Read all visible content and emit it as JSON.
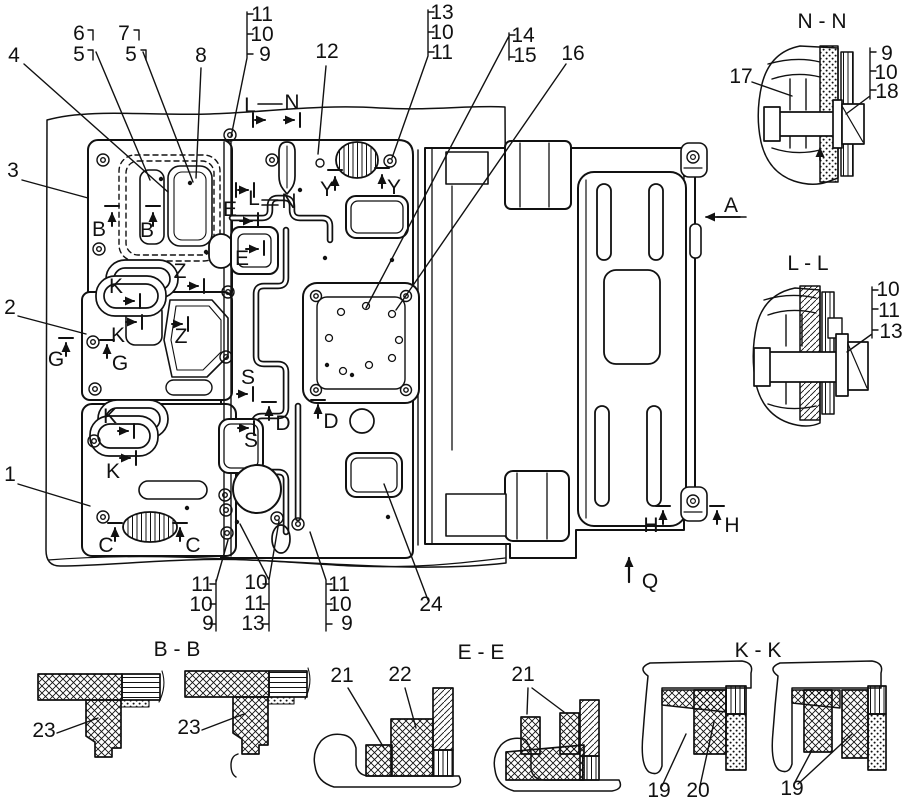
{
  "figure": {
    "type": "engine-gasket-assembly-parts-diagram",
    "background": "#ffffff",
    "line_color": "#111111"
  },
  "legend": {
    "section_views": [
      "N - N",
      "L - L",
      "B - B",
      "E - E",
      "K - K"
    ],
    "callout_numbers": [
      "1",
      "2",
      "3",
      "4",
      "5",
      "6",
      "7",
      "8",
      "9",
      "10",
      "11",
      "12",
      "13",
      "14",
      "15",
      "16",
      "17",
      "18",
      "19",
      "20",
      "21",
      "22",
      "23",
      "24"
    ],
    "view_letters": [
      "A",
      "B",
      "C",
      "D",
      "E",
      "G",
      "H",
      "K",
      "L",
      "N",
      "Q",
      "S",
      "Y",
      "Z"
    ]
  },
  "labels": [
    {
      "t": "4",
      "x": 14,
      "y": 62,
      "n": "callout-4"
    },
    {
      "t": "6",
      "x": 79,
      "y": 40,
      "n": "callout-6"
    },
    {
      "t": "5",
      "x": 79,
      "y": 61,
      "n": "callout-5a"
    },
    {
      "t": "7",
      "x": 124,
      "y": 40,
      "n": "callout-7"
    },
    {
      "t": "5",
      "x": 131,
      "y": 61,
      "n": "callout-5b"
    },
    {
      "t": "8",
      "x": 201,
      "y": 62,
      "n": "callout-8"
    },
    {
      "t": "11",
      "x": 262,
      "y": 21,
      "n": "callout-11-top"
    },
    {
      "t": "10",
      "x": 262,
      "y": 41,
      "n": "callout-10-top"
    },
    {
      "t": "9",
      "x": 265,
      "y": 61,
      "n": "callout-9-top"
    },
    {
      "t": "12",
      "x": 327,
      "y": 58,
      "n": "callout-12"
    },
    {
      "t": "13",
      "x": 442,
      "y": 19,
      "n": "callout-13-top"
    },
    {
      "t": "10",
      "x": 442,
      "y": 39,
      "n": "callout-10-top2"
    },
    {
      "t": "11",
      "x": 442,
      "y": 59,
      "n": "callout-11-top2"
    },
    {
      "t": "14",
      "x": 523,
      "y": 42,
      "n": "callout-14"
    },
    {
      "t": "15",
      "x": 525,
      "y": 62,
      "n": "callout-15"
    },
    {
      "t": "16",
      "x": 573,
      "y": 60,
      "n": "callout-16"
    },
    {
      "t": "3",
      "x": 13,
      "y": 177,
      "n": "callout-3"
    },
    {
      "t": "2",
      "x": 10,
      "y": 314,
      "n": "callout-2"
    },
    {
      "t": "1",
      "x": 10,
      "y": 481,
      "n": "callout-1"
    },
    {
      "t": "17",
      "x": 741,
      "y": 83,
      "n": "callout-17"
    },
    {
      "t": "9",
      "x": 887,
      "y": 60,
      "n": "callout-9-nn"
    },
    {
      "t": "10",
      "x": 886,
      "y": 79,
      "n": "callout-10-nn"
    },
    {
      "t": "18",
      "x": 887,
      "y": 98,
      "n": "callout-18"
    },
    {
      "t": "10",
      "x": 888,
      "y": 296,
      "n": "callout-10-ll"
    },
    {
      "t": "11",
      "x": 889,
      "y": 317,
      "n": "callout-11-ll"
    },
    {
      "t": "13",
      "x": 891,
      "y": 338,
      "n": "callout-13-ll"
    },
    {
      "t": "24",
      "x": 431,
      "y": 611,
      "n": "callout-24"
    },
    {
      "t": "11",
      "x": 202,
      "y": 591,
      "n": "callout-11-bl"
    },
    {
      "t": "10",
      "x": 201,
      "y": 611,
      "n": "callout-10-bl"
    },
    {
      "t": "9",
      "x": 208,
      "y": 630,
      "n": "callout-9-bl"
    },
    {
      "t": "10",
      "x": 256,
      "y": 589,
      "n": "callout-10-bm"
    },
    {
      "t": "11",
      "x": 255,
      "y": 610,
      "n": "callout-11-bm"
    },
    {
      "t": "13",
      "x": 253,
      "y": 630,
      "n": "callout-13-bm"
    },
    {
      "t": "11",
      "x": 339,
      "y": 591,
      "n": "callout-11-br"
    },
    {
      "t": "10",
      "x": 340,
      "y": 611,
      "n": "callout-10-br"
    },
    {
      "t": "9",
      "x": 347,
      "y": 630,
      "n": "callout-9-br"
    },
    {
      "t": "23",
      "x": 44,
      "y": 737,
      "n": "callout-23a"
    },
    {
      "t": "23",
      "x": 189,
      "y": 734,
      "n": "callout-23b"
    },
    {
      "t": "21",
      "x": 342,
      "y": 682,
      "n": "callout-21a"
    },
    {
      "t": "22",
      "x": 400,
      "y": 681,
      "n": "callout-22"
    },
    {
      "t": "21",
      "x": 523,
      "y": 681,
      "n": "callout-21b"
    },
    {
      "t": "19",
      "x": 659,
      "y": 797,
      "n": "callout-19a"
    },
    {
      "t": "20",
      "x": 698,
      "y": 797,
      "n": "callout-20"
    },
    {
      "t": "19",
      "x": 792,
      "y": 795,
      "n": "callout-19b"
    },
    {
      "t": "N - N",
      "x": 822,
      "y": 28,
      "n": "section-title-nn"
    },
    {
      "t": "L - L",
      "x": 808,
      "y": 270,
      "n": "section-title-ll"
    },
    {
      "t": "B - B",
      "x": 177,
      "y": 656,
      "n": "section-title-bb"
    },
    {
      "t": "E - E",
      "x": 481,
      "y": 659,
      "n": "section-title-ee"
    },
    {
      "t": "K - K",
      "x": 758,
      "y": 657,
      "n": "section-title-kk"
    },
    {
      "t": "A",
      "x": 731,
      "y": 212,
      "n": "view-letter-a"
    },
    {
      "t": "Q",
      "x": 650,
      "y": 588,
      "n": "view-letter-q"
    },
    {
      "t": "B",
      "x": 99,
      "y": 236,
      "n": "view-letter-b1"
    },
    {
      "t": "B",
      "x": 147,
      "y": 237,
      "n": "view-letter-b2"
    },
    {
      "t": "L",
      "x": 250,
      "y": 112,
      "n": "view-letter-l1"
    },
    {
      "t": "N",
      "x": 292,
      "y": 109,
      "n": "view-letter-n1"
    },
    {
      "t": "L",
      "x": 254,
      "y": 205,
      "n": "view-letter-l2"
    },
    {
      "t": "N",
      "x": 289,
      "y": 208,
      "n": "view-letter-n2"
    },
    {
      "t": "E",
      "x": 230,
      "y": 216,
      "n": "view-letter-e1"
    },
    {
      "t": "E",
      "x": 242,
      "y": 265,
      "n": "view-letter-e2"
    },
    {
      "t": "Y",
      "x": 327,
      "y": 196,
      "n": "view-letter-y1"
    },
    {
      "t": "Y",
      "x": 394,
      "y": 194,
      "n": "view-letter-y2"
    },
    {
      "t": "Z",
      "x": 180,
      "y": 278,
      "n": "view-letter-z1"
    },
    {
      "t": "Z",
      "x": 181,
      "y": 343,
      "n": "view-letter-z2"
    },
    {
      "t": "K",
      "x": 116,
      "y": 293,
      "n": "view-letter-k1"
    },
    {
      "t": "K",
      "x": 118,
      "y": 342,
      "n": "view-letter-k2"
    },
    {
      "t": "K",
      "x": 110,
      "y": 423,
      "n": "view-letter-k3"
    },
    {
      "t": "K",
      "x": 113,
      "y": 478,
      "n": "view-letter-k4"
    },
    {
      "t": "G",
      "x": 56,
      "y": 366,
      "n": "view-letter-g1"
    },
    {
      "t": "G",
      "x": 120,
      "y": 370,
      "n": "view-letter-g2"
    },
    {
      "t": "S",
      "x": 248,
      "y": 384,
      "n": "view-letter-s1"
    },
    {
      "t": "S",
      "x": 251,
      "y": 447,
      "n": "view-letter-s2"
    },
    {
      "t": "D",
      "x": 283,
      "y": 430,
      "n": "view-letter-d1"
    },
    {
      "t": "D",
      "x": 331,
      "y": 428,
      "n": "view-letter-d2"
    },
    {
      "t": "C",
      "x": 106,
      "y": 552,
      "n": "view-letter-c1"
    },
    {
      "t": "C",
      "x": 193,
      "y": 552,
      "n": "view-letter-c2"
    },
    {
      "t": "H",
      "x": 651,
      "y": 532,
      "n": "view-letter-h1"
    },
    {
      "t": "H",
      "x": 732,
      "y": 532,
      "n": "view-letter-h2"
    }
  ]
}
